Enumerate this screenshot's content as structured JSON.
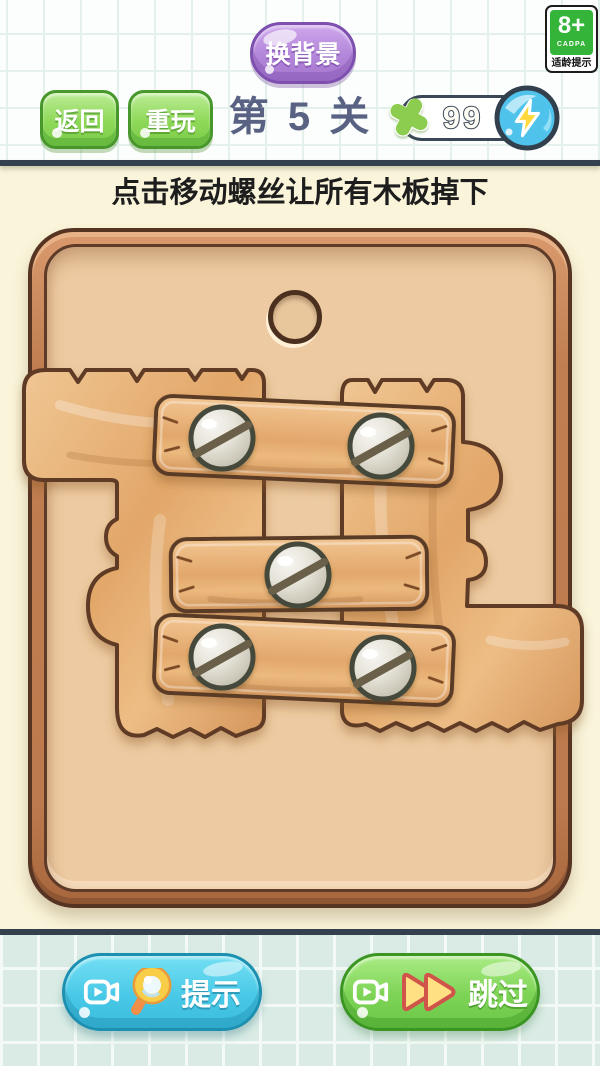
{
  "age_badge": {
    "rating": "8+",
    "org": "CADPA",
    "tip": "适龄提示"
  },
  "top_bar": {
    "change_bg_label": "换背景",
    "back_label": "返回",
    "replay_label": "重玩",
    "level_label": "第 5 关",
    "energy_count": "99"
  },
  "instruction": "点击移动螺丝让所有木板掉下",
  "bottom_bar": {
    "hint_label": "提示",
    "skip_label": "跳过"
  },
  "icons": {
    "energy_plus": "plus-sparkle-icon",
    "energy_coin": "lightning-coin-icon",
    "hint_button": [
      "video-ad-icon",
      "magnifier-icon"
    ],
    "skip_button": [
      "video-ad-icon",
      "fast-forward-icon"
    ]
  },
  "colors": {
    "accent_purple": "#ad7fd6",
    "accent_green": "#7cc94e",
    "accent_cyan": "#49c9e7",
    "separator_navy": "#34404d",
    "board_interior": "#edcaa1",
    "board_frame": "#bd7a4e",
    "plank_wood": "#e2a76b",
    "badge_green": "#35b43a",
    "coin_blue": "#4fc3ec",
    "bolt_yellow": "#ffd93e"
  }
}
